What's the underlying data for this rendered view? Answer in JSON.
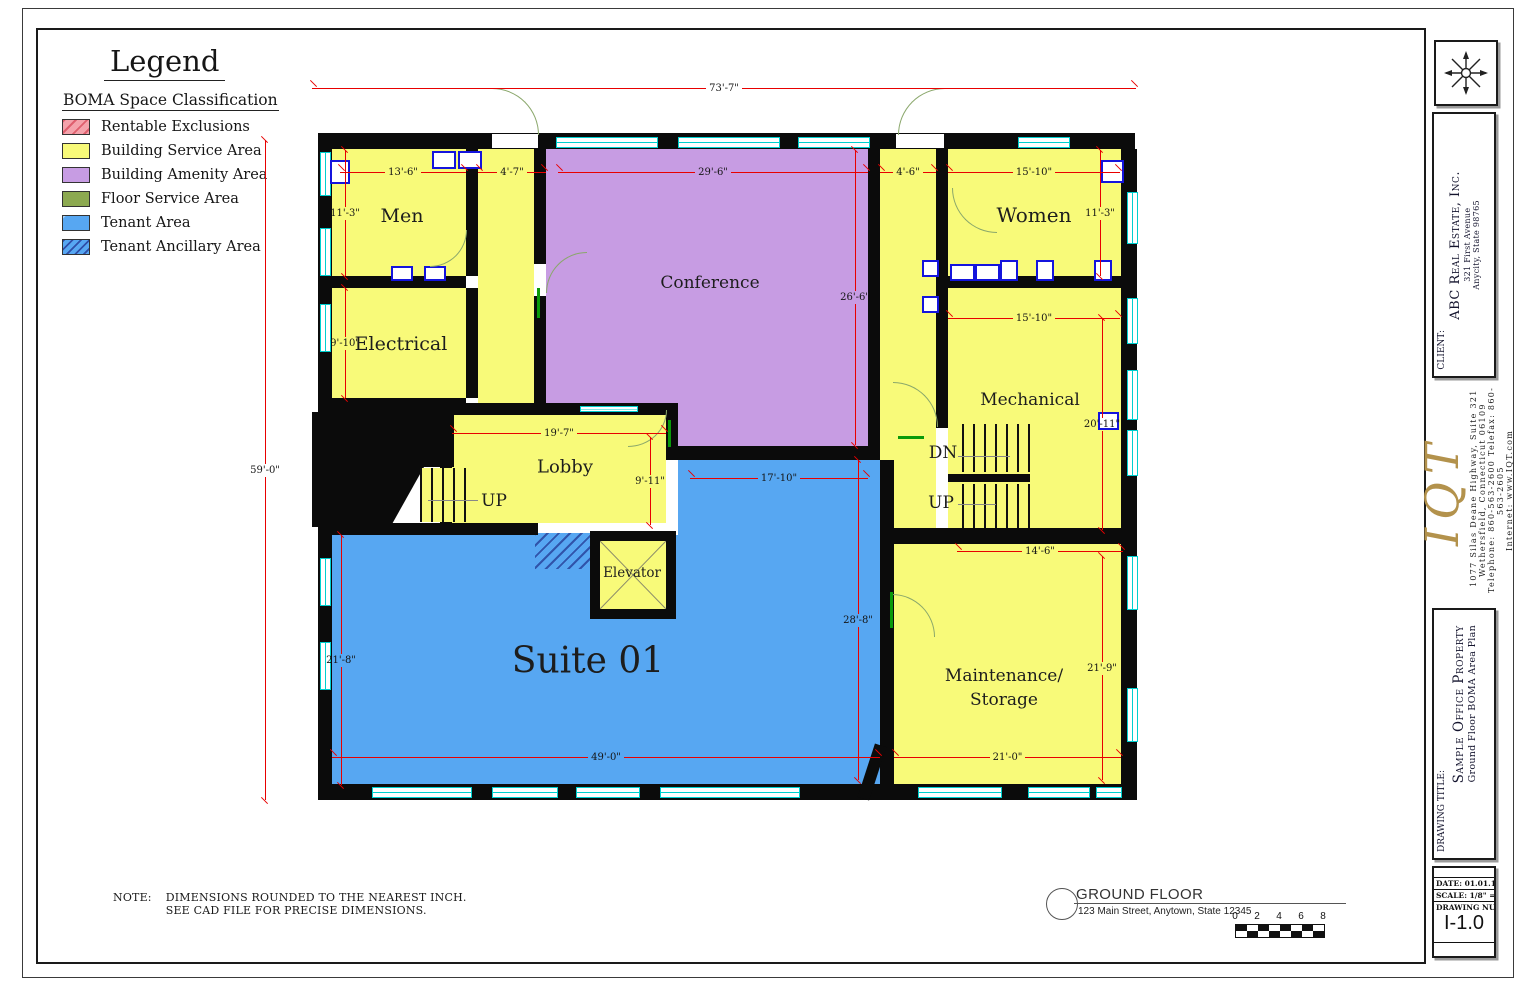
{
  "legend": {
    "title": "Legend",
    "subtitle": "BOMA Space Classification",
    "items": [
      {
        "label": "Rentable Exclusions",
        "color": "#f4a2ab",
        "hatch": "red-diagonal"
      },
      {
        "label": "Building Service Area",
        "color": "#f8fa79",
        "hatch": "none"
      },
      {
        "label": "Building Amenity Area",
        "color": "#c79ce3",
        "hatch": "none"
      },
      {
        "label": "Floor Service Area",
        "color": "#8ca950",
        "hatch": "none"
      },
      {
        "label": "Tenant Area",
        "color": "#57a7f2",
        "hatch": "none"
      },
      {
        "label": "Tenant Ancillary Area",
        "color": "#57a7f2",
        "hatch": "blue-diagonal"
      }
    ]
  },
  "plan": {
    "rooms": {
      "men": "Men",
      "electrical": "Electrical",
      "conference": "Conference",
      "women": "Women",
      "mechanical": "Mechanical",
      "lobby": "Lobby",
      "elevator": "Elevator",
      "suite": "Suite 01",
      "maintenance_line1": "Maintenance/",
      "maintenance_line2": "Storage",
      "up_left": "UP",
      "dn_right": "DN",
      "up_right": "UP"
    },
    "dimensions": [
      {
        "text": "73'-7\""
      },
      {
        "text": "59'-0\""
      },
      {
        "text": "13'-6\""
      },
      {
        "text": "4'-7\""
      },
      {
        "text": "29'-6\""
      },
      {
        "text": "4'-6\""
      },
      {
        "text": "15'-10\""
      },
      {
        "text": "11'-3\""
      },
      {
        "text": "11'-3\""
      },
      {
        "text": "9'-10\""
      },
      {
        "text": "26'-6\""
      },
      {
        "text": "15'-10\""
      },
      {
        "text": "19'-7\""
      },
      {
        "text": "9'-11\""
      },
      {
        "text": "17'-10\""
      },
      {
        "text": "20'-11\""
      },
      {
        "text": "14'-6\""
      },
      {
        "text": "21'-8\""
      },
      {
        "text": "28'-8\""
      },
      {
        "text": "21'-9\""
      },
      {
        "text": "49'-0\""
      },
      {
        "text": "21'-0\""
      }
    ]
  },
  "note": {
    "label": "NOTE:",
    "line1": "DIMENSIONS ROUNDED TO THE NEAREST INCH.",
    "line2": "SEE CAD FILE FOR PRECISE DIMENSIONS."
  },
  "footer": {
    "title": "GROUND FLOOR",
    "address": "123 Main Street, Anytown, State  12345",
    "scale_ticks": [
      "0",
      "2",
      "4",
      "6",
      "8"
    ]
  },
  "titleblock": {
    "client_label": "CLIENT:",
    "client_name": "ABC Real Estate, Inc.",
    "client_addr1": "321 First Avenue",
    "client_addr2": "Anycity, State  98765",
    "firm_logo": "IQT",
    "firm_addr1": "1077 Silas Deane Highway, Suite 321",
    "firm_addr2": "Wethersfield, Connecticut  06109",
    "firm_addr3": "Telephone: 860-563-2600  Telefax: 860-563-2605",
    "firm_addr4": "Internet: www.IQT.com",
    "drawing_title_label": "DRAWING TITLE:",
    "drawing_title": "Sample Office Property",
    "drawing_subtitle": "Ground Floor BOMA Area Plan",
    "date_label": "DATE:",
    "date": "01.01.10",
    "scale_label": "SCALE:",
    "scale": "1/8\" = 1'-0\"",
    "number_label": "DRAWING NUMBER",
    "number": "I-1.0"
  },
  "colors": {
    "service_yellow": "#f8fa79",
    "amenity_purple": "#c79ce3",
    "tenant_blue": "#57a7f2",
    "exclusion_pink": "#f4a2ab",
    "floor_service_olive": "#8ca950",
    "window_cyan": "#00cfcf",
    "dimension_red": "#e80000",
    "logo_gold": "#b3924c"
  }
}
